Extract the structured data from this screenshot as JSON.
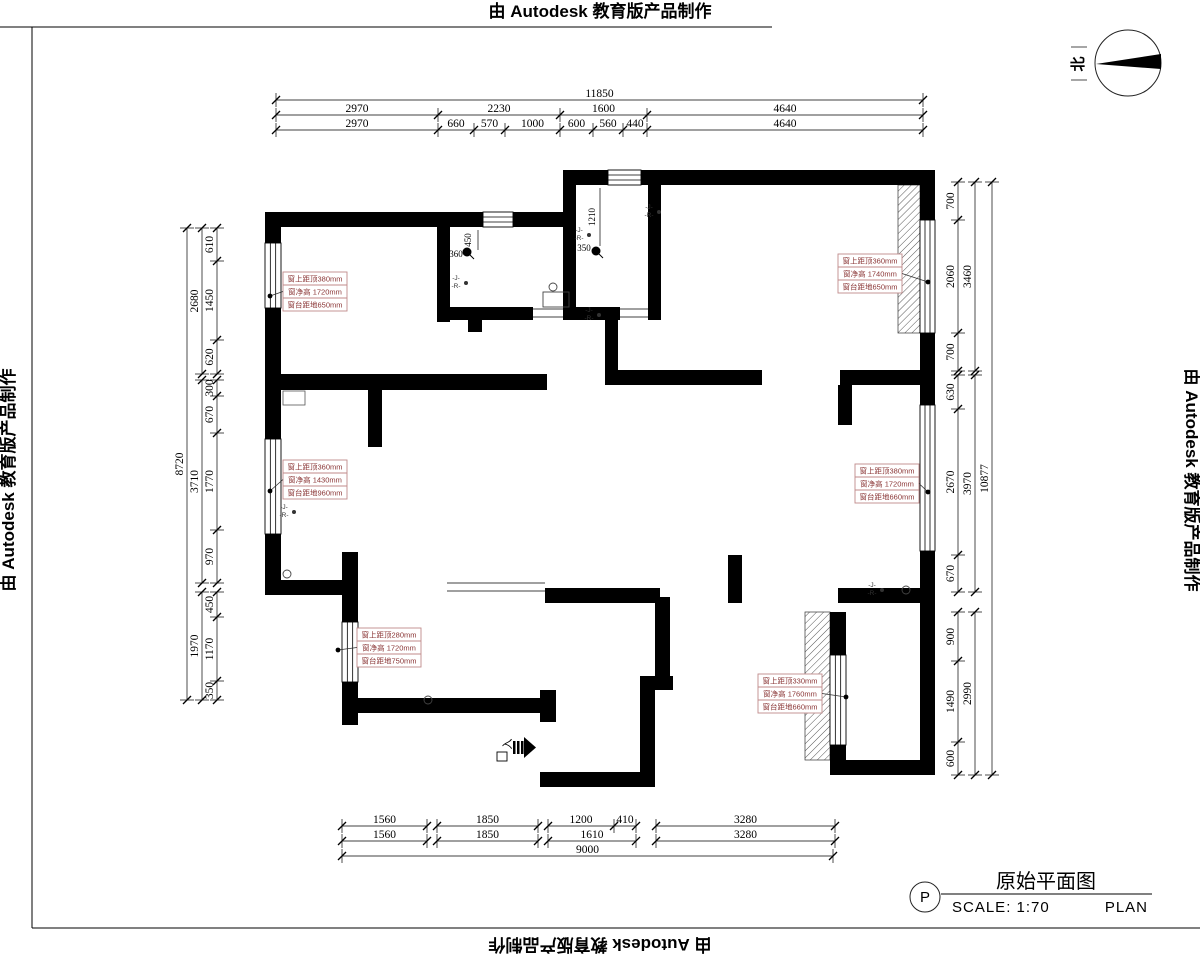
{
  "sheet": {
    "stamps": {
      "top": "由 Autodesk 教育版产品制作",
      "left": "由 Autodesk 教育版产品制作",
      "right": "由 Autodesk 教育版产品制作",
      "bottom": "由 Autodesk 教育版产品制作"
    },
    "north_label": "北"
  },
  "title_block": {
    "marker": "P",
    "title": "原始平面图",
    "scale": "SCALE:  1:70",
    "plan": "PLAN"
  },
  "dimensions": {
    "top_rows": [
      [
        "11850"
      ],
      [
        "2970",
        "2230",
        "1600",
        "4640"
      ],
      [
        "2970",
        "660",
        "570",
        "1000",
        "600",
        "560",
        "440",
        "4640"
      ]
    ],
    "bottom_rows": [
      [
        "1560",
        "1850",
        "1200",
        "410",
        "3280"
      ],
      [
        "1560",
        "1850",
        "1610",
        "3280"
      ],
      [
        "9000"
      ]
    ],
    "left_cols": {
      "outer": [
        "8720"
      ],
      "middle": [
        "2680",
        "3710",
        "1970"
      ],
      "inner": [
        "610",
        "1450",
        "620",
        "300",
        "670",
        "1770",
        "970",
        "450",
        "1170",
        "350"
      ]
    },
    "right_cols": {
      "inner": [
        "700",
        "2060",
        "700",
        "630",
        "2670",
        "670",
        "900",
        "1490",
        "600"
      ],
      "middle": [
        "3460",
        "3970",
        "2990"
      ],
      "outer": [
        "10877"
      ]
    }
  },
  "interior_dims": {
    "bath1_v": "450",
    "bath1_h": "360",
    "bath2_h": "350",
    "bath2_v": "1210"
  },
  "window_labels": [
    {
      "rows": [
        "窗上距顶380mm",
        "窗净高 1720mm",
        "窗台距地650mm"
      ]
    },
    {
      "rows": [
        "窗上距顶360mm",
        "窗净高 1430mm",
        "窗台距地960mm"
      ]
    },
    {
      "rows": [
        "窗上距顶280mm",
        "窗净高 1720mm",
        "窗台距地750mm"
      ]
    },
    {
      "rows": [
        "窗上距顶360mm",
        "窗净高 1740mm",
        "窗台距地650mm"
      ]
    },
    {
      "rows": [
        "窗上距顶380mm",
        "窗净高 1720mm",
        "窗台距地660mm"
      ]
    },
    {
      "rows": [
        "窗上距顶330mm",
        "窗净高 1760mm",
        "窗台距地660mm"
      ]
    }
  ],
  "plumbing": {
    "cold": "J",
    "hot": "R"
  },
  "entry_label": "入",
  "colors": {
    "wall": "#000000",
    "label_red": "#8a3535",
    "label_box": "#c08a8a"
  }
}
